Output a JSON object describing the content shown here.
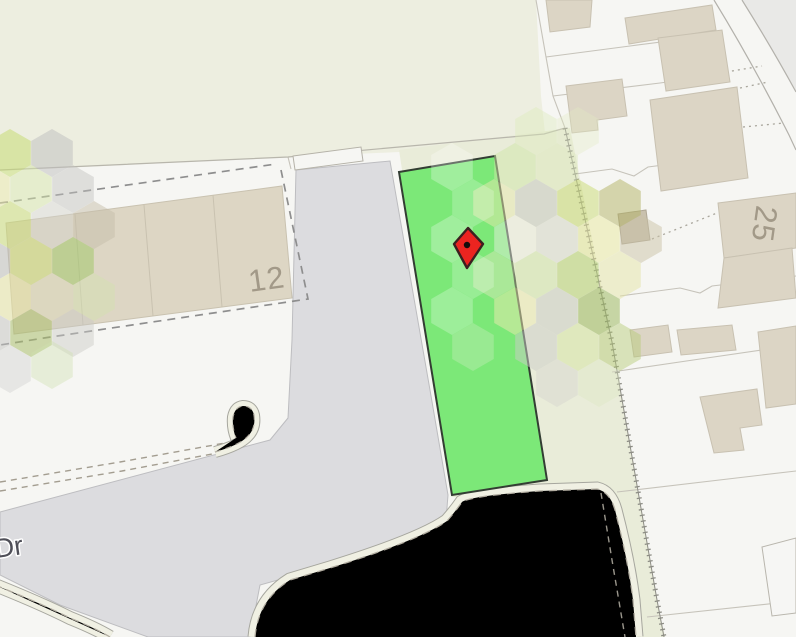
{
  "map": {
    "labels": {
      "parcel_left": {
        "text": "12"
      },
      "parcel_right": {
        "text": "25"
      },
      "road": {
        "text": "Dr"
      }
    },
    "marker": {
      "name": "selected-location",
      "x": 468,
      "y": 245,
      "fill": "#eb2420",
      "outline": "#3c2020",
      "dot": "#140c0c"
    },
    "highlight_parcel": {
      "fill": "#7ce878",
      "outline": "#333d33"
    },
    "palette": {
      "openland": "#edeee0",
      "corridor": "#e9ecd9",
      "white_parcel": "#f6f6f3",
      "road_gray": "#dcdcdf",
      "building_beige": "#dcd5c5",
      "building_dark": "#c9c1ae",
      "path_cream": "#f0f0e3",
      "boundary_dash": "#8e8e8e",
      "parcel_line": "#c6c3ba"
    },
    "hex_overlay": {
      "radius": 24,
      "cells": [
        [
          10,
          153,
          "#c6dc74",
          0.55
        ],
        [
          52,
          153,
          "#bdbdbd",
          0.5
        ],
        [
          -11,
          189,
          "#e6e6a6",
          0.55
        ],
        [
          31,
          189,
          "#d4e4a8",
          0.5
        ],
        [
          73,
          189,
          "#c2c2be",
          0.45
        ],
        [
          10,
          225,
          "#c8da78",
          0.55
        ],
        [
          52,
          225,
          "#d2d2cc",
          0.45
        ],
        [
          94,
          225,
          "#c6beaa",
          0.5
        ],
        [
          -11,
          261,
          "#b8b8b6",
          0.5
        ],
        [
          31,
          261,
          "#ccdc7a",
          0.55
        ],
        [
          73,
          261,
          "#a2c86c",
          0.55
        ],
        [
          10,
          297,
          "#e4e2a2",
          0.55
        ],
        [
          52,
          297,
          "#dcd8ba",
          0.5
        ],
        [
          94,
          297,
          "#d2e2b0",
          0.45
        ],
        [
          -11,
          333,
          "#c2c2c0",
          0.5
        ],
        [
          31,
          333,
          "#a9bd6b",
          0.55
        ],
        [
          73,
          333,
          "#c9c9c5",
          0.45
        ],
        [
          10,
          369,
          "#d0d0cc",
          0.4
        ],
        [
          52,
          365,
          "#cfe0ae",
          0.4
        ],
        [
          536,
          131,
          "#dcecb8",
          0.4
        ],
        [
          578,
          131,
          "#e2ecc4",
          0.35
        ],
        [
          515,
          167,
          "#cfe6a8",
          0.5
        ],
        [
          557,
          167,
          "#dce8b8",
          0.45
        ],
        [
          452,
          167,
          "#ffffff",
          0.28
        ],
        [
          494,
          203,
          "#e8e8b0",
          0.5
        ],
        [
          536,
          203,
          "#c6c6c2",
          0.5
        ],
        [
          578,
          203,
          "#ccdc7c",
          0.55
        ],
        [
          620,
          203,
          "#b2b264",
          0.5
        ],
        [
          473,
          203,
          "#ffffff",
          0.22
        ],
        [
          515,
          239,
          "#f0f0e6",
          0.45
        ],
        [
          557,
          239,
          "#dadad6",
          0.45
        ],
        [
          599,
          239,
          "#e8e89e",
          0.5
        ],
        [
          641,
          239,
          "#cac1a6",
          0.5
        ],
        [
          452,
          239,
          "#ffffff",
          0.28
        ],
        [
          494,
          275,
          "#d8e8b8",
          0.5
        ],
        [
          536,
          275,
          "#d2e4ac",
          0.5
        ],
        [
          578,
          275,
          "#bad478",
          0.55
        ],
        [
          620,
          275,
          "#e4e4a6",
          0.5
        ],
        [
          473,
          275,
          "#ffffff",
          0.22
        ],
        [
          515,
          311,
          "#eeeab2",
          0.5
        ],
        [
          557,
          311,
          "#cacac6",
          0.5
        ],
        [
          599,
          311,
          "#9eba62",
          0.55
        ],
        [
          452,
          311,
          "#ffffff",
          0.25
        ],
        [
          536,
          347,
          "#ccccc8",
          0.5
        ],
        [
          578,
          347,
          "#d6e4a2",
          0.5
        ],
        [
          620,
          347,
          "#b4ca74",
          0.45
        ],
        [
          473,
          347,
          "#f0f0e0",
          0.25
        ],
        [
          557,
          383,
          "#d2d2ce",
          0.4
        ],
        [
          599,
          383,
          "#dce8c0",
          0.35
        ]
      ]
    }
  }
}
